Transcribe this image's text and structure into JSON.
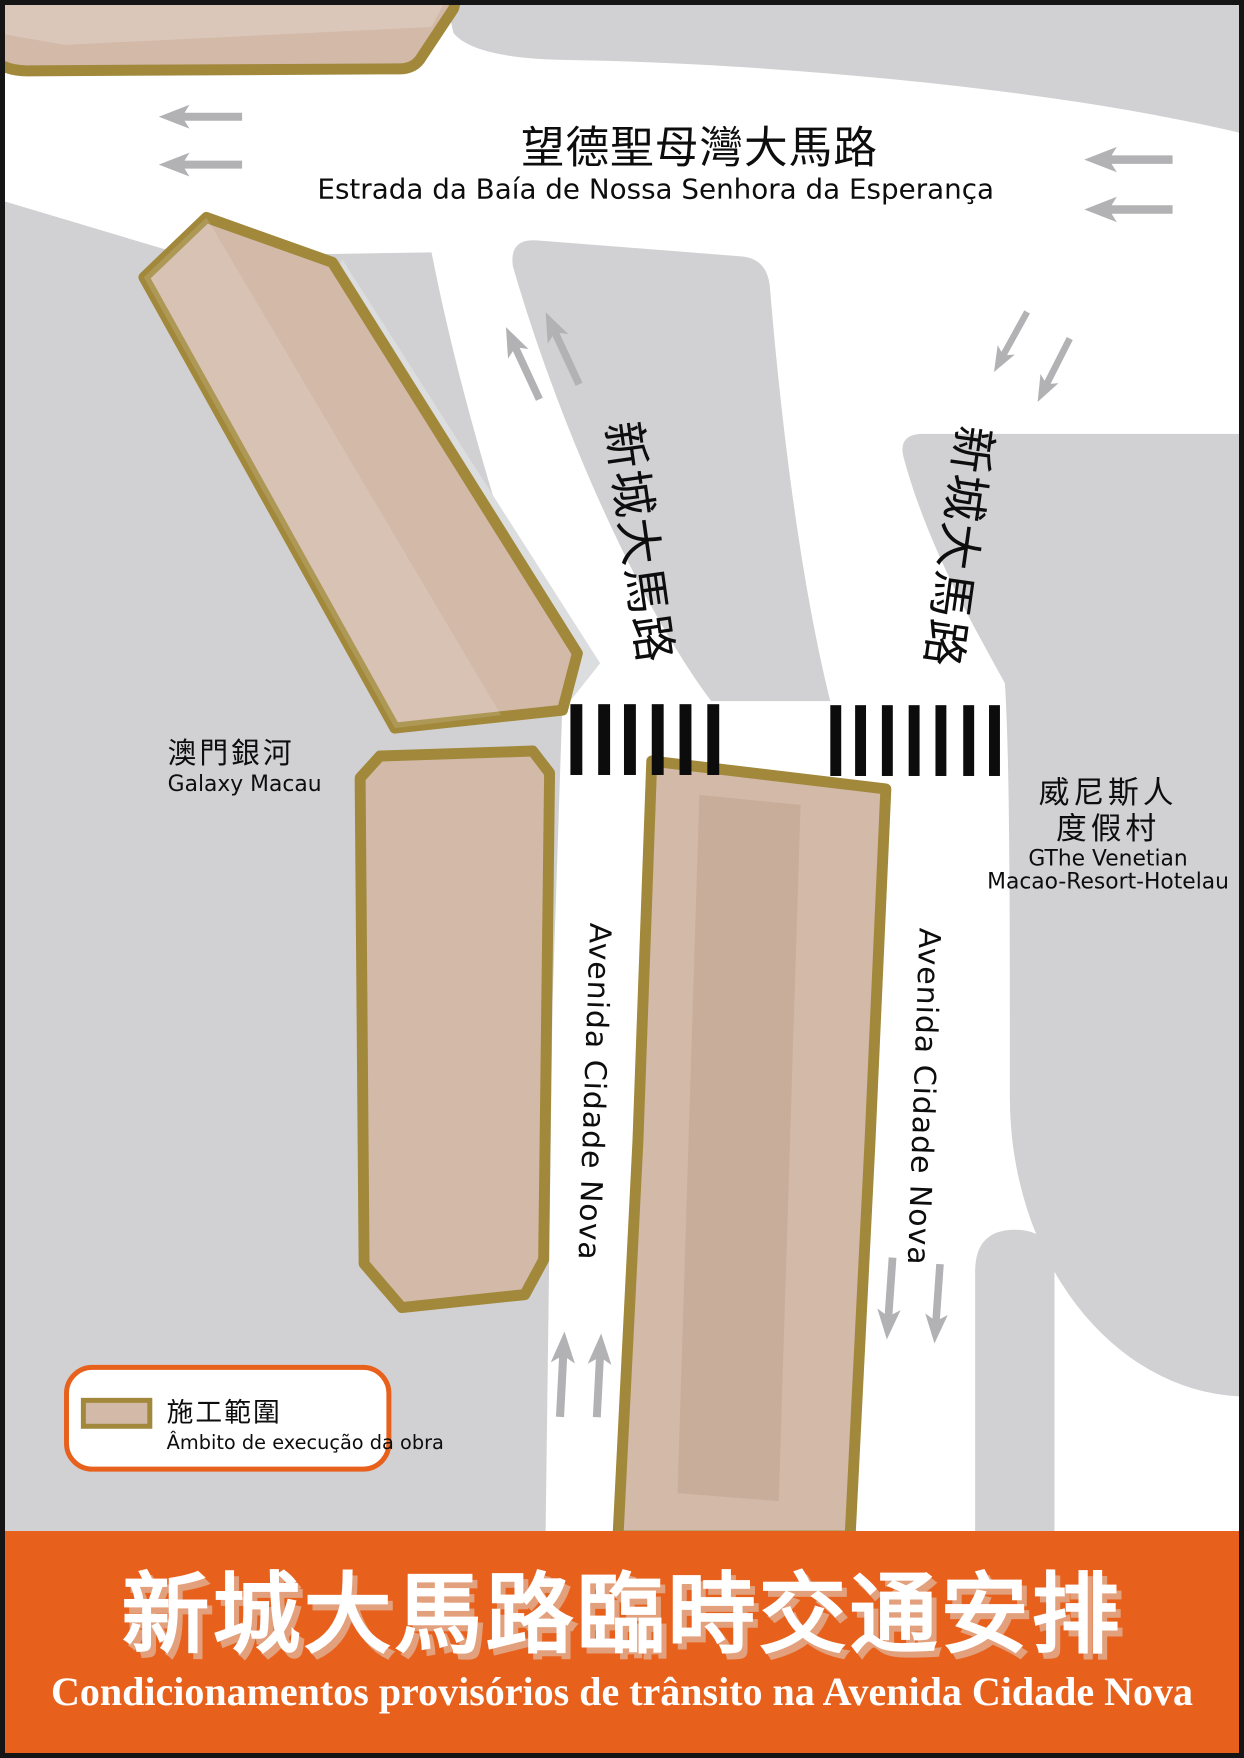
{
  "poster": {
    "top_road": {
      "name_zh": "望德聖母灣大馬路",
      "name_pt": "Estrada da Baía de Nossa Senhora da Esperança"
    },
    "branch_roads": {
      "left_zh": "新城大馬路",
      "right_zh": "新城大馬路"
    },
    "avenues": {
      "left_pt": "Avenida Cidade Nova",
      "right_pt": "Avenida Cidade Nova"
    },
    "landmarks": {
      "galaxy_zh": "澳門銀河",
      "galaxy_en": "Galaxy Macau",
      "venetian_zh_line1": "威尼斯人",
      "venetian_zh_line2": "度假村",
      "venetian_en_line1": "GThe Venetian",
      "venetian_en_line2": "Macao-Resort-Hotelau"
    },
    "legend": {
      "label_zh": "施工範圍",
      "label_pt": "Âmbito de execução da obra"
    },
    "banner": {
      "title_zh": "新城大馬路臨時交通安排",
      "subtitle_pt": "Condicionamentos provisórios de trânsito na Avenida Cidade Nova"
    },
    "colors": {
      "construction_fill": "#d2b9a8",
      "construction_border": "#a1883b",
      "construction_inner_band": "#c9ad9b",
      "road_white": "#ffffff",
      "block_gray": "#d1d1d3",
      "edge_shadow_gray": "#dbddde",
      "arrow_gray": "#b2b2b4",
      "crosswalk_black": "#0c0c0c",
      "banner_orange": "#e8611c",
      "frame_black": "#151515"
    }
  }
}
